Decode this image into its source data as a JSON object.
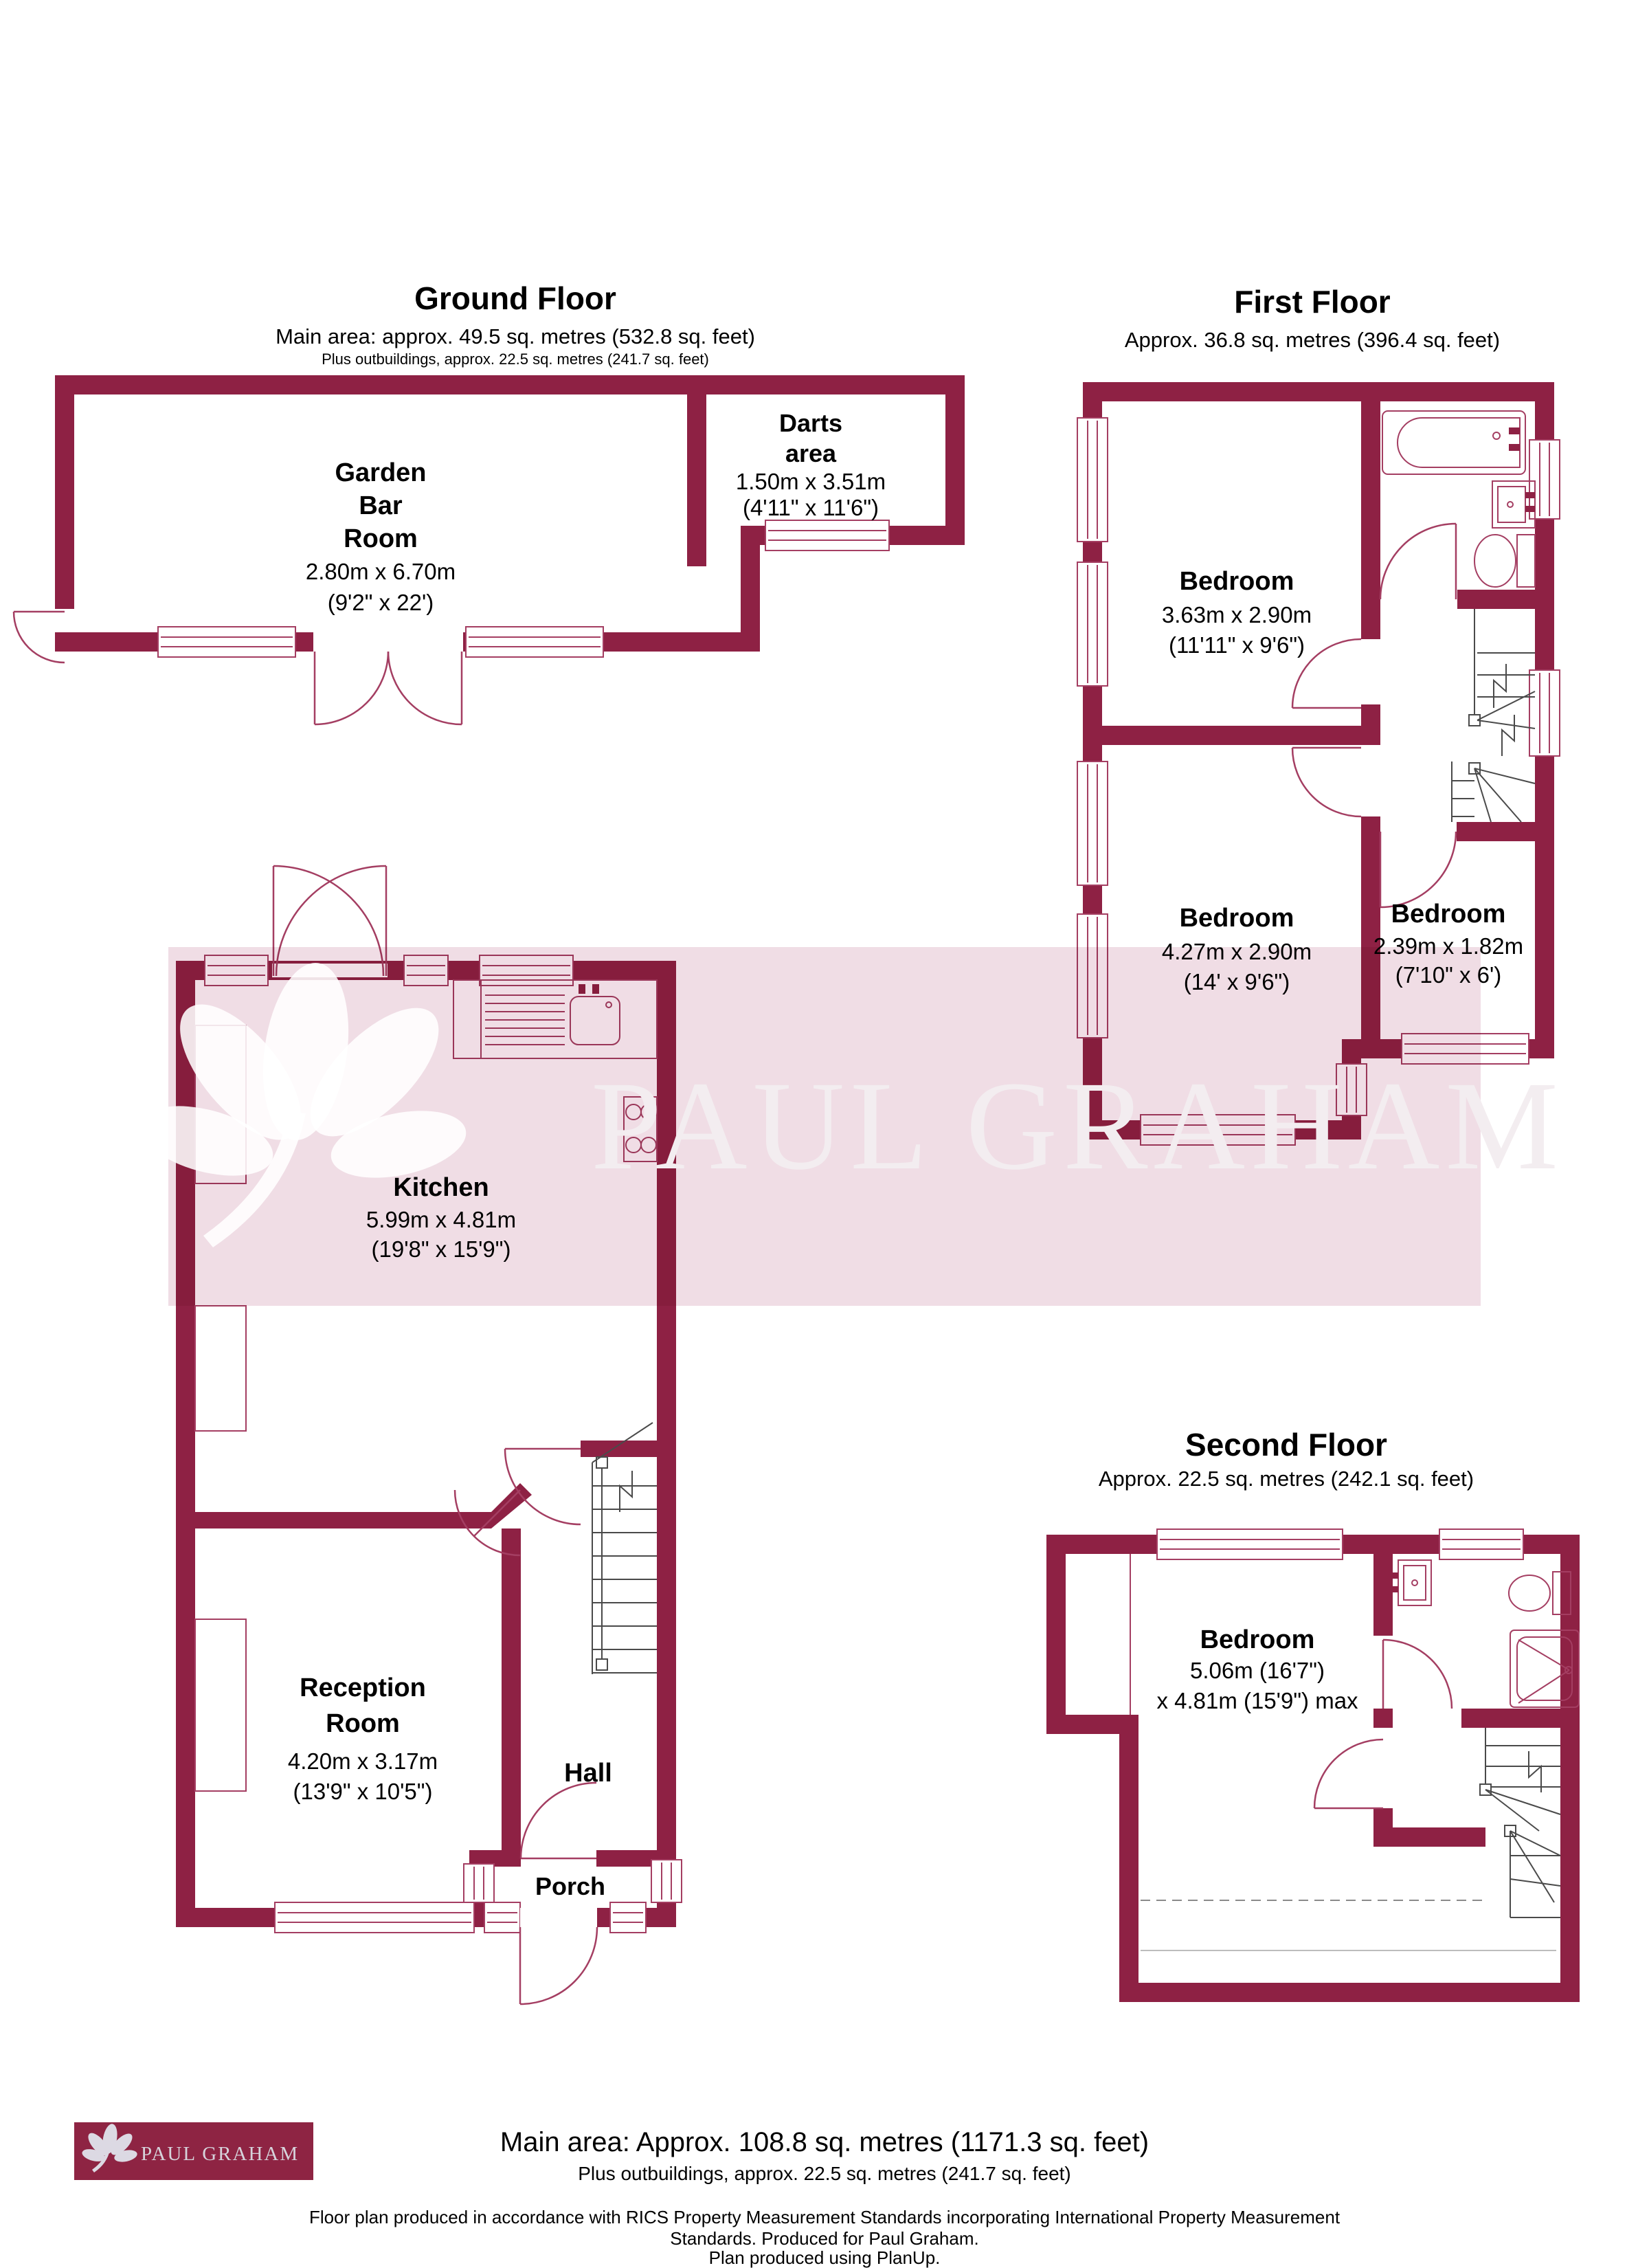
{
  "colors": {
    "wall": "#8E2144",
    "thin_line": "#A43E62",
    "stair_line": "#4a4a4a",
    "watermark_band": "#F0DDE5",
    "watermark_text_color": "#F3EDF0",
    "logo_background": "#8E2443",
    "logo_text_color": "#D6D3DB"
  },
  "ground_floor": {
    "title": "Ground Floor",
    "subtitle": "Main area: approx. 49.5 sq. metres (532.8 sq. feet)",
    "subtitle2": "Plus outbuildings, approx. 22.5 sq. metres (241.7 sq. feet)",
    "garden_bar_room": {
      "name_lines": [
        "Garden",
        "Bar",
        "Room"
      ],
      "dims": "2.80m x 6.70m",
      "dims_imperial": "(9'2\" x 22')"
    },
    "darts_area": {
      "name_lines": [
        "Darts",
        "area"
      ],
      "dims": "1.50m x 3.51m",
      "dims_imperial": "(4'11\" x 11'6\")"
    },
    "kitchen": {
      "name": "Kitchen",
      "dims": "5.99m x 4.81m",
      "dims_imperial": "(19'8\" x 15'9\")"
    },
    "reception_room": {
      "name_lines": [
        "Reception",
        "Room"
      ],
      "dims": "4.20m x 3.17m",
      "dims_imperial": "(13'9\" x 10'5\")"
    },
    "hall": {
      "name": "Hall"
    },
    "porch": {
      "name": "Porch"
    }
  },
  "first_floor": {
    "title": "First Floor",
    "subtitle": "Approx. 36.8 sq. metres (396.4 sq. feet)",
    "bedroom1": {
      "name": "Bedroom",
      "dims": "3.63m x 2.90m",
      "dims_imperial": "(11'11\" x 9'6\")"
    },
    "bedroom2": {
      "name": "Bedroom",
      "dims": "4.27m x 2.90m",
      "dims_imperial": "(14' x 9'6\")"
    },
    "bedroom3": {
      "name": "Bedroom",
      "dims": "2.39m x 1.82m",
      "dims_imperial": "(7'10\" x 6')"
    }
  },
  "second_floor": {
    "title": "Second Floor",
    "subtitle": "Approx. 22.5 sq. metres (242.1 sq. feet)",
    "bedroom": {
      "name": "Bedroom",
      "dims": "5.06m (16'7\")",
      "dims2": "x 4.81m (15'9\") max"
    }
  },
  "watermark": {
    "text": "PAUL GRAHAM"
  },
  "footer": {
    "logo_text": "PAUL GRAHAM",
    "main_area": "Main area: Approx. 108.8 sq. metres (1171.3 sq. feet)",
    "outbuildings": "Plus outbuildings, approx. 22.5 sq. metres (241.7 sq. feet)",
    "disclaimer_line1": "Floor plan produced in accordance with RICS Property Measurement Standards incorporating International Property Measurement",
    "disclaimer_line2": "Standards. Produced for Paul Graham.",
    "produced_with": "Plan produced using PlanUp."
  }
}
